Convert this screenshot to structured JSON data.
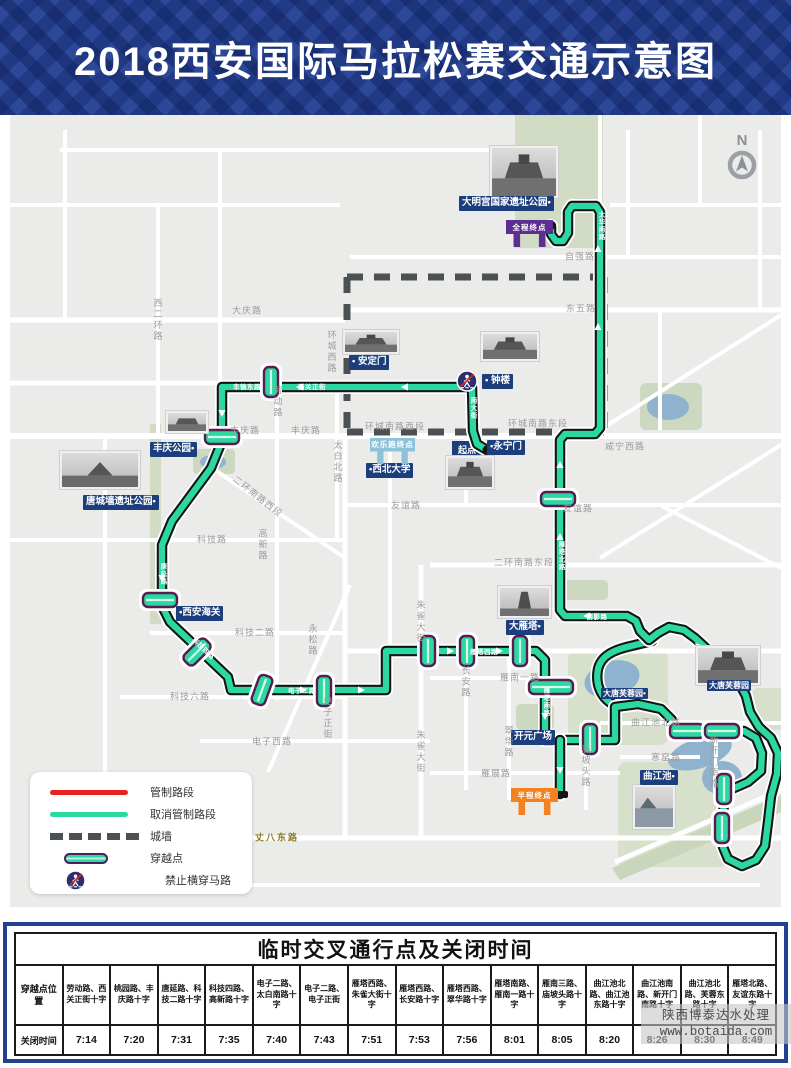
{
  "header": {
    "title": "2018西安国际马拉松赛交通示意图"
  },
  "map": {
    "compass": "N",
    "start_label": "起点",
    "landmarks": [
      {
        "name": "daminggong-park",
        "text": "大明宫国家遗址公园•",
        "x": 459,
        "y": 196
      },
      {
        "name": "andingmen",
        "text": "• 安定门",
        "x": 349,
        "y": 355
      },
      {
        "name": "zhonglou",
        "text": "• 钟楼",
        "x": 482,
        "y": 374
      },
      {
        "name": "yongningmen",
        "text": "•永宁门",
        "x": 487,
        "y": 440
      },
      {
        "name": "fengqing-park",
        "text": "丰庆公园•",
        "x": 150,
        "y": 442
      },
      {
        "name": "tangchengqiang-park",
        "text": "唐城墙遗址公园•",
        "x": 83,
        "y": 495
      },
      {
        "name": "xian-customs",
        "text": "•西安海关",
        "x": 176,
        "y": 606
      },
      {
        "name": "xibei-university",
        "text": "•西北大学",
        "x": 366,
        "y": 463
      },
      {
        "name": "dayanta",
        "text": "大雁塔•",
        "x": 506,
        "y": 620
      },
      {
        "name": "datang-furongyuan-west",
        "text": "大唐芙蓉园•",
        "x": 601,
        "y": 688,
        "small": 1
      },
      {
        "name": "datang-furongyuan",
        "text": "大唐芙蓉园",
        "x": 707,
        "y": 680,
        "small": 1
      },
      {
        "name": "kaiyuan-square",
        "text": "开元广场",
        "x": 511,
        "y": 730
      },
      {
        "name": "qujiangchi",
        "text": "曲江池•",
        "x": 640,
        "y": 770
      }
    ],
    "banners": [
      {
        "name": "full-finish",
        "text": "全程终点",
        "x": 506,
        "y": 220,
        "w": 47,
        "h": 27,
        "color": "#5c2e91"
      },
      {
        "name": "funrun-finish",
        "text": "欢乐跑终点",
        "x": 370,
        "y": 438,
        "w": 45,
        "h": 26,
        "color": "#8cc3db"
      },
      {
        "name": "half-finish",
        "text": "半程终点",
        "x": 511,
        "y": 788,
        "w": 47,
        "h": 27,
        "color": "#f48120"
      }
    ],
    "road_labels": [
      {
        "text": "大庆路",
        "x": 247,
        "y": 310
      },
      {
        "text": "西二环路",
        "x": 158,
        "y": 320,
        "v": 1
      },
      {
        "text": "环城西路",
        "x": 332,
        "y": 352,
        "v": 1
      },
      {
        "text": "劳动路",
        "x": 278,
        "y": 402,
        "v": 1
      },
      {
        "text": "自强路",
        "x": 580,
        "y": 256
      },
      {
        "text": "东五路",
        "x": 581,
        "y": 308
      },
      {
        "text": "丰庆路",
        "x": 245,
        "y": 430
      },
      {
        "text": "丰庆路",
        "x": 306,
        "y": 430
      },
      {
        "text": "太白北路",
        "x": 338,
        "y": 462,
        "v": 1
      },
      {
        "text": "环城南路西段",
        "x": 395,
        "y": 426
      },
      {
        "text": "环城南路东段",
        "x": 538,
        "y": 423
      },
      {
        "text": "咸宁西路",
        "x": 625,
        "y": 446
      },
      {
        "text": "友谊路",
        "x": 406,
        "y": 505
      },
      {
        "text": "友谊路",
        "x": 578,
        "y": 508
      },
      {
        "text": "二环南路西段",
        "x": 258,
        "y": 496,
        "rot": 38
      },
      {
        "text": "二环南路东段",
        "x": 524,
        "y": 562
      },
      {
        "text": "科技路",
        "x": 212,
        "y": 539
      },
      {
        "text": "高新路",
        "x": 263,
        "y": 545,
        "v": 1
      },
      {
        "text": "科技二路",
        "x": 255,
        "y": 632
      },
      {
        "text": "科技六路",
        "x": 190,
        "y": 696
      },
      {
        "text": "永松路",
        "x": 313,
        "y": 640,
        "v": 1
      },
      {
        "text": "电子正街",
        "x": 328,
        "y": 718,
        "v": 1
      },
      {
        "text": "电子西路",
        "x": 272,
        "y": 741
      },
      {
        "text": "朱雀大街",
        "x": 421,
        "y": 622,
        "v": 1
      },
      {
        "text": "朱雀大街",
        "x": 421,
        "y": 752,
        "v": 1
      },
      {
        "text": "长安路",
        "x": 466,
        "y": 682,
        "v": 1
      },
      {
        "text": "翠华路",
        "x": 509,
        "y": 742,
        "v": 1
      },
      {
        "text": "雁南一路",
        "x": 520,
        "y": 677
      },
      {
        "text": "雁展路",
        "x": 496,
        "y": 773
      },
      {
        "text": "庙坡头路",
        "x": 586,
        "y": 766,
        "v": 1
      },
      {
        "text": "曲江池北路",
        "x": 656,
        "y": 722
      },
      {
        "text": "寒窑路",
        "x": 666,
        "y": 757
      },
      {
        "text": "新开门南路",
        "x": 714,
        "y": 762,
        "v": 1
      },
      {
        "text": "丈八东路",
        "x": 277,
        "y": 837,
        "olive": 1
      }
    ],
    "route_labels": [
      {
        "text": "丰镐东路",
        "x": 247,
        "y": 386
      },
      {
        "text": "西关正街",
        "x": 312,
        "y": 386
      },
      {
        "text": "南大街",
        "x": 472,
        "y": 408,
        "v": 1
      },
      {
        "text": "唐延路",
        "x": 162,
        "y": 574,
        "v": 1
      },
      {
        "text": "科技四路",
        "x": 204,
        "y": 648,
        "rot": 44
      },
      {
        "text": "电子二路",
        "x": 302,
        "y": 690
      },
      {
        "text": "雁塔西路",
        "x": 484,
        "y": 651
      },
      {
        "text": "雁塔南路",
        "x": 545,
        "y": 702,
        "v": 1
      },
      {
        "text": "雁塔北路",
        "x": 560,
        "y": 556,
        "v": 1
      },
      {
        "text": "太华南路",
        "x": 600,
        "y": 226,
        "v": 1
      },
      {
        "text": "西影路",
        "x": 597,
        "y": 616
      }
    ],
    "legend": {
      "items": [
        "管制路段",
        "取消管制路段",
        "城墙",
        "穿越点",
        "禁止横穿马路"
      ]
    },
    "colors": {
      "route": "#2bd8a2",
      "controlled": "#e8231f",
      "wall": "#4a5054",
      "label_bg": "#1c3e7d",
      "full_finish": "#5c2e91",
      "funrun_finish": "#8cc3db",
      "half_finish": "#f48120"
    },
    "crossings": [
      {
        "x": 271,
        "y": 382,
        "o": "v"
      },
      {
        "x": 222,
        "y": 437,
        "o": "h"
      },
      {
        "x": 160,
        "y": 600,
        "o": "h"
      },
      {
        "x": 197,
        "y": 652,
        "o": "v",
        "rot": 45
      },
      {
        "x": 262,
        "y": 690,
        "o": "v",
        "rot": 20
      },
      {
        "x": 324,
        "y": 691,
        "o": "v"
      },
      {
        "x": 428,
        "y": 651,
        "o": "v"
      },
      {
        "x": 467,
        "y": 651,
        "o": "v"
      },
      {
        "x": 520,
        "y": 651,
        "o": "v"
      },
      {
        "x": 551,
        "y": 687,
        "o": "hw"
      },
      {
        "x": 590,
        "y": 739,
        "o": "v"
      },
      {
        "x": 687,
        "y": 731,
        "o": "h"
      },
      {
        "x": 722,
        "y": 731,
        "o": "h"
      },
      {
        "x": 724,
        "y": 789,
        "o": "v"
      },
      {
        "x": 722,
        "y": 828,
        "o": "v"
      },
      {
        "x": 558,
        "y": 499,
        "o": "h"
      }
    ]
  },
  "watermark": {
    "line1": "陕西博泰达水处理",
    "line2": "www.botaida.com"
  },
  "table": {
    "title": "临时交叉通行点及关闭时间",
    "row1_header": "穿越点位置",
    "row2_header": "关闭时间",
    "columns": [
      {
        "location": "劳动路、西关正街十字",
        "time": "7:14"
      },
      {
        "location": "桃园路、丰庆路十字",
        "time": "7:20"
      },
      {
        "location": "唐延路、科技二路十字",
        "time": "7:31"
      },
      {
        "location": "科技四路、高新路十字",
        "time": "7:35"
      },
      {
        "location": "电子二路、太白南路十字",
        "time": "7:40"
      },
      {
        "location": "电子二路、电子正街",
        "time": "7:43"
      },
      {
        "location": "雁塔西路、朱雀大街十字",
        "time": "7:51"
      },
      {
        "location": "雁塔西路、长安路十字",
        "time": "7:53"
      },
      {
        "location": "雁塔西路、翠华路十字",
        "time": "7:56"
      },
      {
        "location": "雁塔南路、雁南一路十字",
        "time": "8:01"
      },
      {
        "location": "雁南三路、庙坡头路十字",
        "time": "8:05"
      },
      {
        "location": "曲江池北路、曲江池东路十字",
        "time": "8:20"
      },
      {
        "location": "曲江池南路、新开门南路十字",
        "time": "8:26"
      },
      {
        "location": "曲江池北路、芙蓉东路十字",
        "time": "8:30"
      },
      {
        "location": "雁塔北路、友谊东路十字",
        "time": "8:49"
      }
    ]
  }
}
